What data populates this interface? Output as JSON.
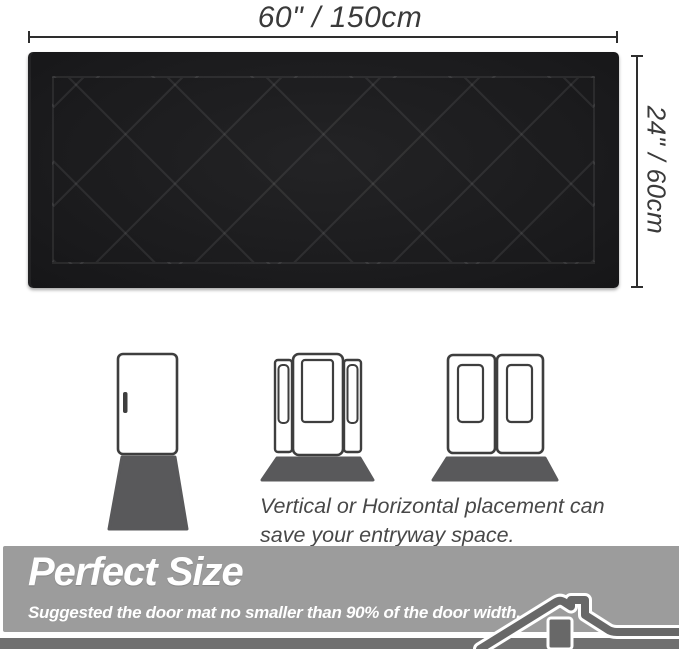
{
  "dimensions": {
    "width_label": "60\" / 150cm",
    "height_label": "24\" / 60cm"
  },
  "mat": {
    "base_color": "#1b1b1d",
    "pattern": "diamond-quilt",
    "pattern_line_color": "rgba(255,255,255,0.08)"
  },
  "placement": {
    "caption_line1": "Vertical or Horizontal placement can",
    "caption_line2": "save your entryway space.",
    "illustrations": [
      {
        "name": "single-door-with-vertical-mat"
      },
      {
        "name": "sidelite-door-with-horizontal-mat"
      },
      {
        "name": "double-door-with-horizontal-mat"
      }
    ],
    "door_outline_color": "#3e3e3e",
    "door_mat_color": "#59595b"
  },
  "banner": {
    "title": "Perfect Size",
    "subtitle": "Suggested the door mat no smaller than 90% of the door width.",
    "background": "#9c9c9c",
    "strip_color": "#707070",
    "text_color": "#ffffff",
    "icon": "house-roof-icon"
  }
}
